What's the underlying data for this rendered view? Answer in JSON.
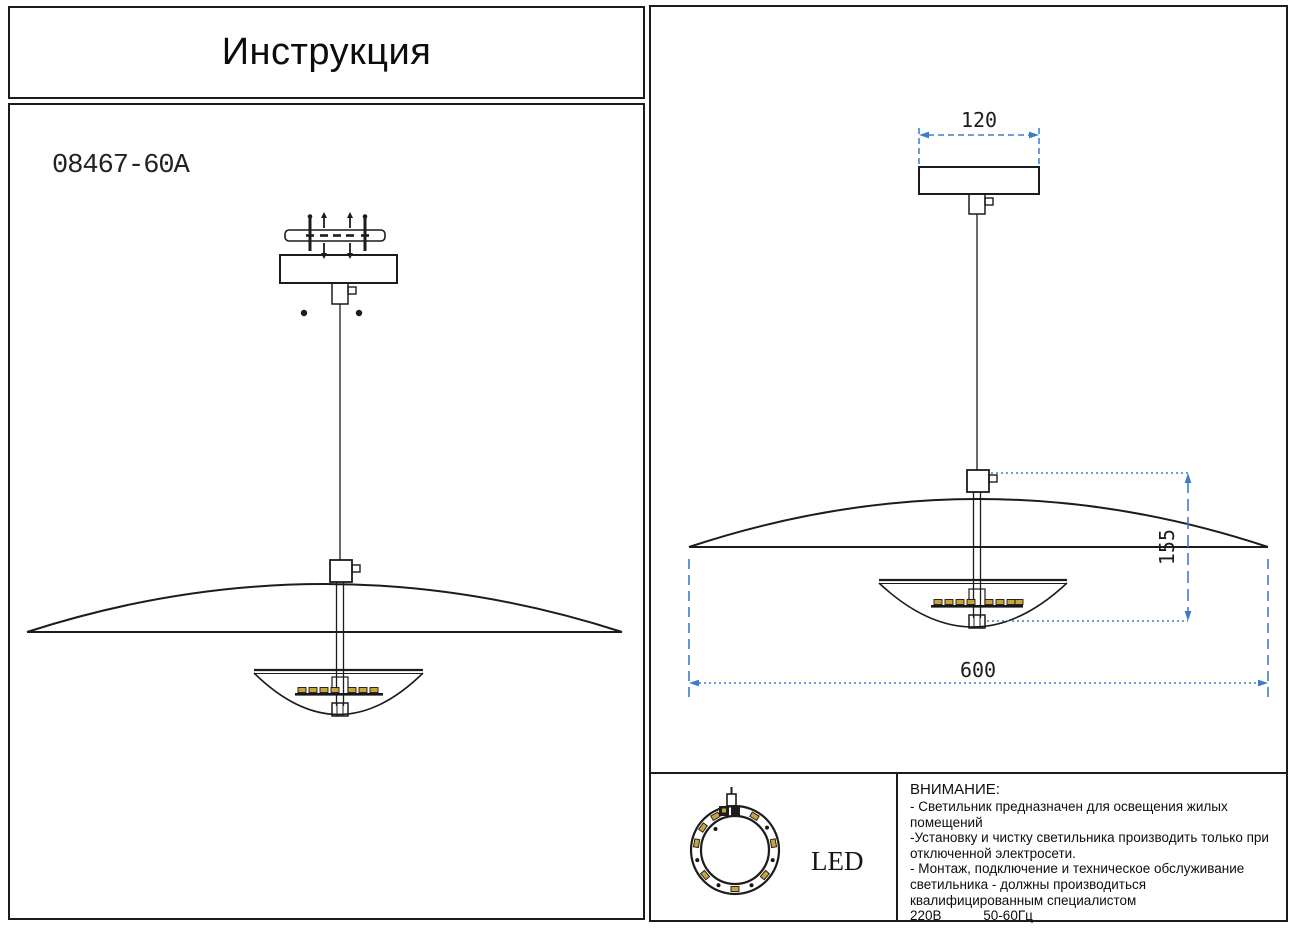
{
  "title": "Инструкция",
  "model": "08467-60A",
  "dimensions": {
    "canopy_width_mm": "120",
    "fixture_height_mm": "155",
    "shade_diameter_mm": "600"
  },
  "led_label": "LED",
  "warning": {
    "heading": "ВНИМАНИЕ:",
    "lines": [
      "- Светильник предназначен для освещения жилых",
      "помещений",
      "-Установку и чистку светильника производить только при",
      "отключенной электросети.",
      "- Монтаж, подключение и техническое обслуживание",
      "светильника - должны производиться",
      "квалифицированным специалистом"
    ],
    "voltage": "220В",
    "frequency": "50-60Гц"
  },
  "colors": {
    "dimension_blue": "#3d7dc7",
    "line_black": "#1c1c1c",
    "led_chip_yellow": "#c9a43b"
  }
}
